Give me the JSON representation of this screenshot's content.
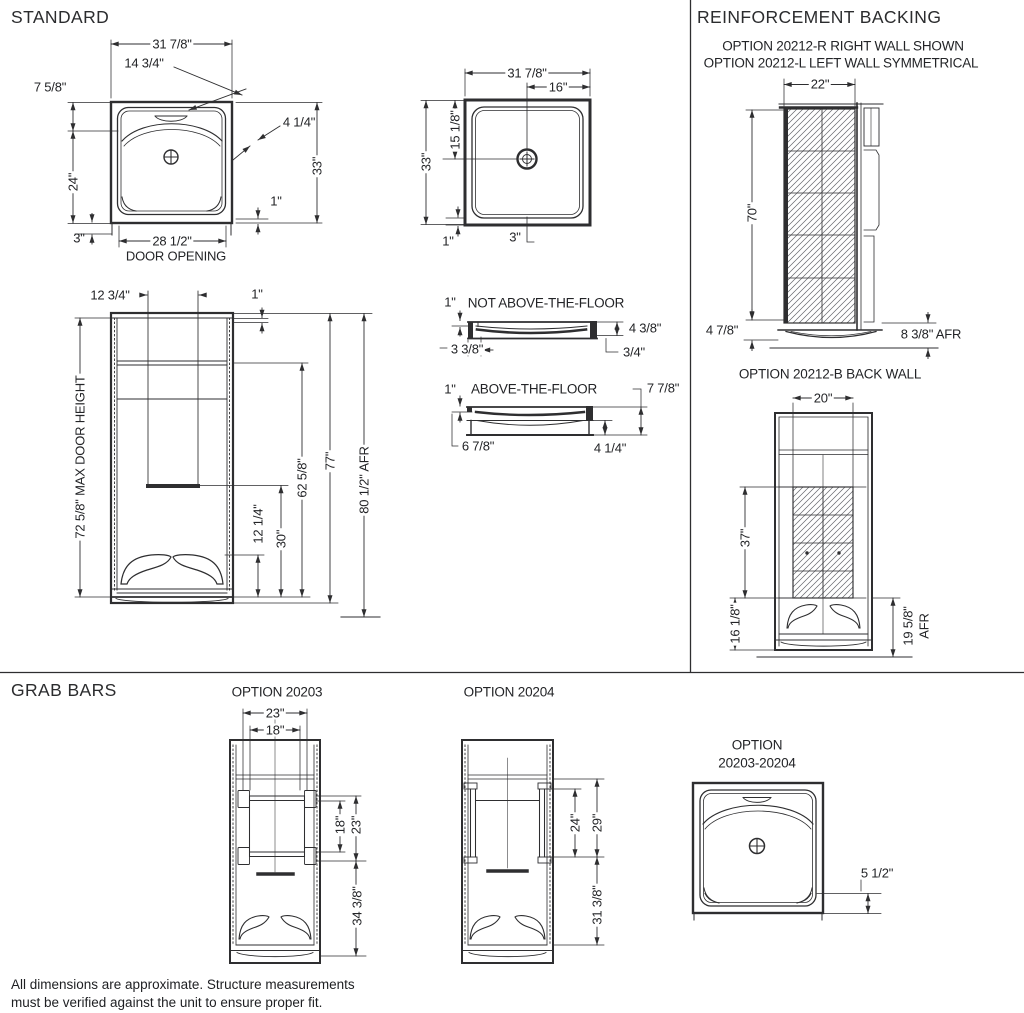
{
  "titles": {
    "standard": "STANDARD",
    "reinforcement": "REINFORCEMENT BACKING",
    "grab_bars": "GRAB BARS"
  },
  "plan1": {
    "width": "31 7/8\"",
    "dam_offset": "14 3/4\"",
    "lip": "7 5/8\"",
    "corner": "4 1/4\"",
    "depth": "33\"",
    "left": "24\"",
    "right_offset": "1\"",
    "left_offset": "3\"",
    "door_width": "28 1/2\"",
    "door_label": "DOOR OPENING"
  },
  "plan2": {
    "width": "31 7/8\"",
    "drain_x": "16\"",
    "depth": "33\"",
    "drain_y": "15 1/8\"",
    "corner_offset": "1\"",
    "drain_offset": "3\""
  },
  "elevation": {
    "shelf_width": "12 3/4\"",
    "top_offset": "1\"",
    "max_door": "72 5/8\" MAX DOOR HEIGHT",
    "inner_height": "62 5/8\"",
    "height": "77\"",
    "afr_height": "80 1/2\" AFR",
    "seat_height": "12 1/4\"",
    "shelf_height": "30\""
  },
  "floor_sections": {
    "not_above": {
      "lip": "1\"",
      "title": "NOT ABOVE-THE-FLOOR",
      "height": "4 3/8\"",
      "left_inset": "3 3/8\"",
      "right_inset": "3/4\""
    },
    "above": {
      "lip": "1\"",
      "title": "ABOVE-THE-FLOOR",
      "height": "7 7/8\"",
      "left_inset": "6 7/8\"",
      "right_inset": "4 1/4\""
    }
  },
  "reinforcement": {
    "subtitle1": "OPTION 20212-R RIGHT WALL SHOWN",
    "subtitle2": "OPTION 20212-L LEFT WALL SYMMETRICAL",
    "back_title": "OPTION 20212-B BACK WALL",
    "side": {
      "width": "22\"",
      "height": "70\"",
      "base_height": "4 7/8\"",
      "afr": "8 3/8\" AFR"
    },
    "back": {
      "width": "20\"",
      "panel_height": "37\"",
      "bottom_height": "16 1/8\"",
      "afr_value": "19 5/8\"",
      "afr_label": "AFR"
    }
  },
  "grab_bars": {
    "opt20203_title": "OPTION 20203",
    "opt20204_title": "OPTION 20204",
    "combo_title1": "OPTION",
    "combo_title2": "20203-20204",
    "opt20203": {
      "outer_width": "23\"",
      "inner_width": "18\"",
      "bar_height": "18\"",
      "mount_height": "23\"",
      "floor_height": "34 3/8\""
    },
    "opt20204": {
      "bar_length": "24\"",
      "mount_length": "29\"",
      "floor_height": "31 3/8\""
    },
    "combo": {
      "edge_offset": "5 1/2\""
    }
  },
  "footer": {
    "line1": "All dimensions are approximate. Structure measurements",
    "line2": "must be verified against the unit to ensure proper fit."
  }
}
